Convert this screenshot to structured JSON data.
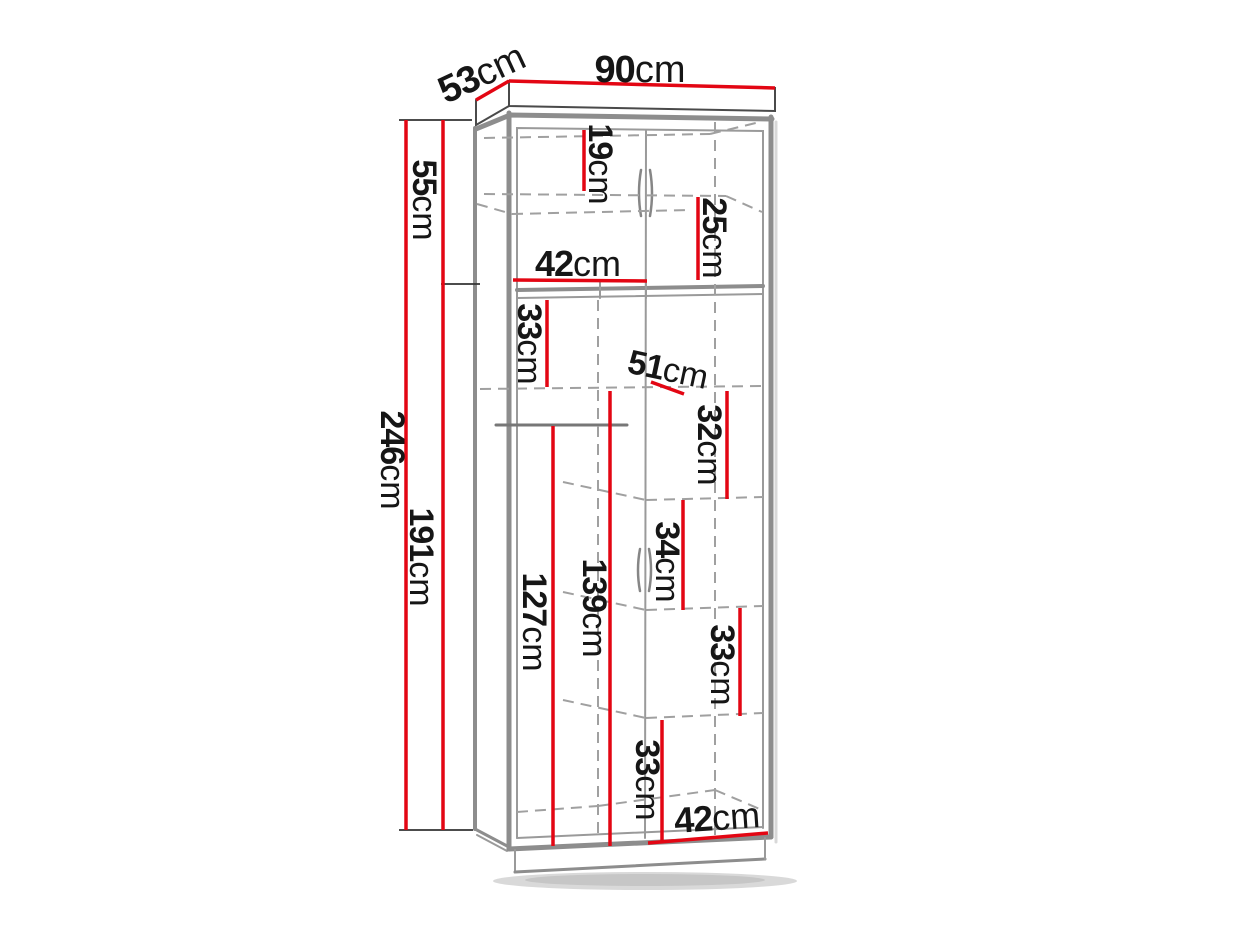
{
  "diagram": {
    "type": "furniture-dimension-drawing",
    "subject": "two-door wardrobe with top cabinet, shelves and hanging rail",
    "unit": "cm",
    "colors": {
      "dimension_line": "#e30613",
      "outline_gray": "#8d8d8d",
      "interior_gray": "#9a9a9a",
      "dashed_gray": "#a0a0a0",
      "extension_black": "#333333",
      "text": "#161616",
      "background": "#ffffff"
    },
    "labels": {
      "w90": {
        "num": "90",
        "unit": "cm"
      },
      "d53": {
        "num": "53",
        "unit": "cm"
      },
      "h246": {
        "num": "246",
        "unit": "cm"
      },
      "h55": {
        "num": "55",
        "unit": "cm"
      },
      "h191": {
        "num": "191",
        "unit": "cm"
      },
      "h19": {
        "num": "19",
        "unit": "cm"
      },
      "h25": {
        "num": "25",
        "unit": "cm"
      },
      "w42top": {
        "num": "42",
        "unit": "cm"
      },
      "h33a": {
        "num": "33",
        "unit": "cm"
      },
      "d51": {
        "num": "51",
        "unit": "cm"
      },
      "h32": {
        "num": "32",
        "unit": "cm"
      },
      "h34": {
        "num": "34",
        "unit": "cm"
      },
      "h33b": {
        "num": "33",
        "unit": "cm"
      },
      "h127": {
        "num": "127",
        "unit": "cm"
      },
      "h139": {
        "num": "139",
        "unit": "cm"
      },
      "h33c": {
        "num": "33",
        "unit": "cm"
      },
      "w42bot": {
        "num": "42",
        "unit": "cm"
      }
    },
    "dimensions_cm": {
      "overall_width": 90,
      "overall_depth": 53,
      "overall_height": 246,
      "top_section_height": 55,
      "lower_section_height": 191,
      "top_upper_gap": 19,
      "top_lower_gap": 25,
      "top_compartment_width": 42,
      "upper_shelf_gap": 33,
      "shelf_depth": 51,
      "shelf_gap_1": 32,
      "shelf_gap_2": 34,
      "shelf_gap_3": 33,
      "left_hanging_height": 127,
      "right_column_height": 139,
      "bottom_compartment_height": 33,
      "bottom_compartment_width": 42
    }
  }
}
